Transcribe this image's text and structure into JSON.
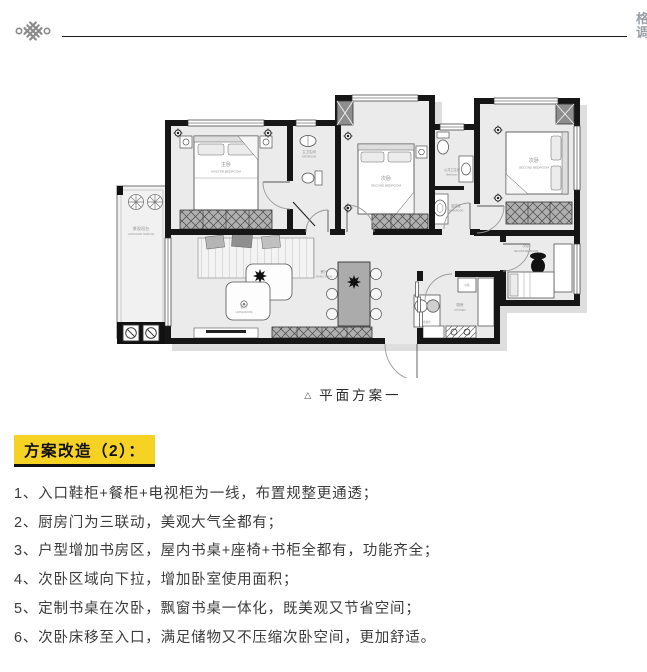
{
  "header": {
    "watermark": "格调"
  },
  "plan": {
    "caption": {
      "marker": "△",
      "text": "平面方案一"
    },
    "rooms": {
      "master": {
        "cn": "主卧",
        "en": "MASTER BEDROOM"
      },
      "terrace": {
        "cn": "景观阳台",
        "en": "LANDSCAPE TERRACE"
      },
      "master_bath": {
        "cn": "主卫生间",
        "en": "BATHROOM"
      },
      "bedroom2": {
        "cn": "次卧",
        "en": "SECOND BEDROOM"
      },
      "public_bath": {
        "cn": "公共卫生间",
        "en": "Bathroom"
      },
      "washroom": {
        "cn": "盥洗区",
        "en": "WASHROOM"
      },
      "bedroom3": {
        "cn": "次卧",
        "en": "SECOND BEDROOM"
      },
      "study_bedroom": {
        "cn": "次卧",
        "en": "SECOND BEDROOM"
      },
      "dining": {
        "cn": "餐厅",
        "en": "DINING ROOM"
      },
      "living": {
        "cn": "客厅",
        "en": "LIVING ROOM"
      },
      "kitchen": {
        "cn": "厨房",
        "en": "KITCHEN"
      },
      "prep": {
        "cn": "备餐台"
      },
      "fridge": {
        "cn": "冰箱"
      }
    }
  },
  "section": {
    "title": "方案改造（2）：",
    "highlight_color": "#F5D223"
  },
  "notes": [
    "1、入口鞋柜+餐柜+电视柜为一线，布置规整更通透；",
    "2、厨房门为三联动，美观大气全都有；",
    "3、户型增加书房区，屋内书桌+座椅+书柜全都有，功能齐全；",
    "4、次卧区域向下拉，增加卧室使用面积；",
    "5、定制书桌在次卧，飘窗书桌一体化，既美观又节省空间；",
    "6、次卧床移至入口，满足储物又不压缩次卧空间，更加舒适。"
  ]
}
